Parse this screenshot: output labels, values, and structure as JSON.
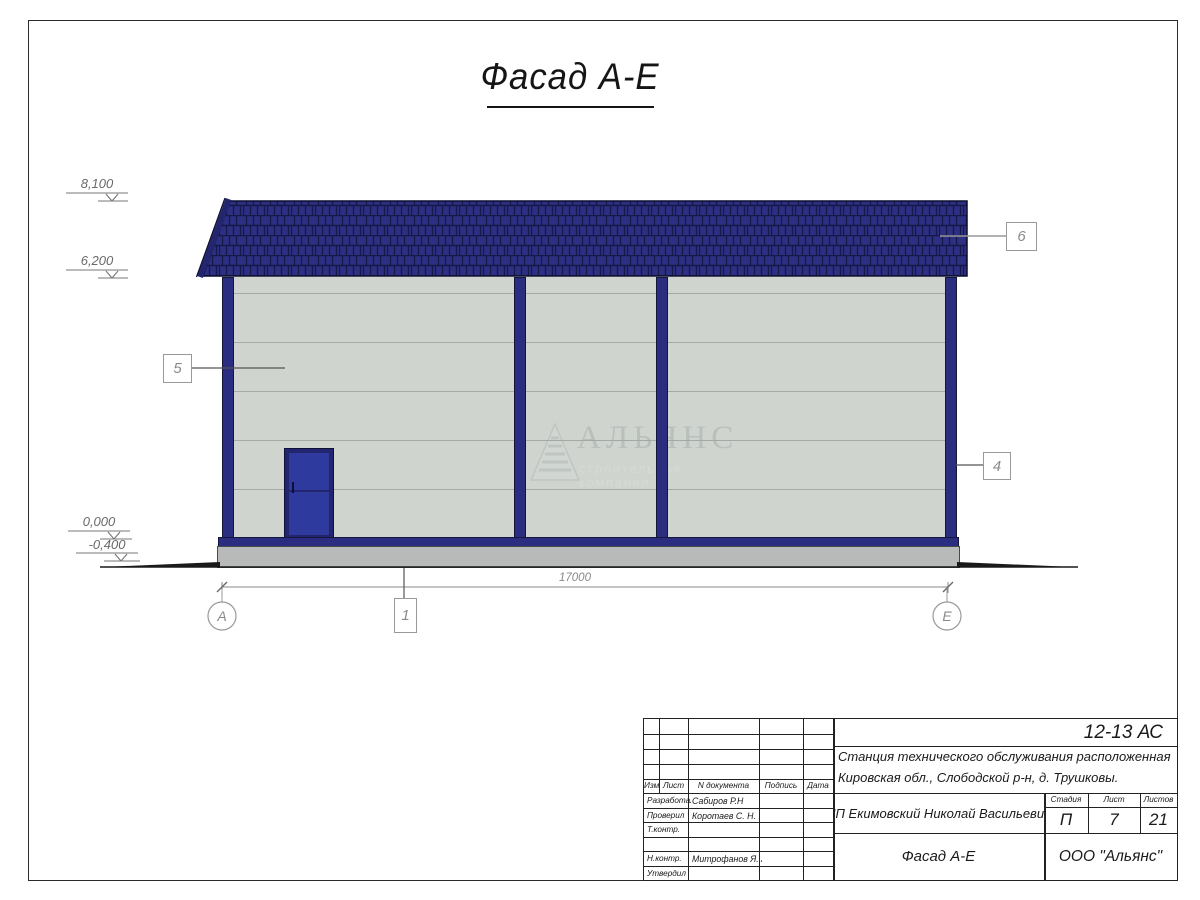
{
  "page": {
    "title": "Фасад А-Е"
  },
  "drawing": {
    "elevation_marks": [
      {
        "value": "8,100"
      },
      {
        "value": "6,200"
      },
      {
        "value": "0,000"
      },
      {
        "value": "-0,400"
      }
    ],
    "callouts": [
      {
        "label": "5"
      },
      {
        "label": "6"
      },
      {
        "label": "4"
      },
      {
        "label": "1"
      }
    ],
    "dimension_total": "17000",
    "axis_left": "А",
    "axis_right": "Е",
    "watermark_title": "АЛЬЯНС",
    "watermark_subtitle": "строительная компания"
  },
  "colors": {
    "roof": "#2c2f82",
    "roof_joint": "#161848",
    "wall": "#cfd4cf",
    "panel_line": "#a3a9a4",
    "trim": "#2b2e80",
    "door": "#2f3a9e",
    "plinth": "#b7bab8"
  },
  "titleblock": {
    "doc_code": "12-13 АС",
    "project_line1": "Станция технического обслуживания расположенная по адресу",
    "project_line2": "Кировская обл., Слободской р-н, д. Трушковы.",
    "client": "ИП Екимовский Николай Васильевич",
    "sheet_name": "Фасад А-Е",
    "company": "ООО \"Альянс\"",
    "stage_label": "Стадия",
    "stage_value": "П",
    "sheet_label": "Лист",
    "sheet_value": "7",
    "sheets_label": "Листов",
    "sheets_value": "21",
    "columns": [
      "Изм.",
      "Лист",
      "N документа",
      "Подпись",
      "Дата"
    ],
    "signature_rows": [
      {
        "role": "Разработал",
        "name": "Сабиров Р.Н"
      },
      {
        "role": "Проверил",
        "name": "Коротаев С. Н."
      },
      {
        "role": "Т.контр.",
        "name": ""
      },
      {
        "role": "",
        "name": ""
      },
      {
        "role": "Н.контр.",
        "name": "Митрофанов Я. А."
      },
      {
        "role": "Утвердил",
        "name": ""
      }
    ]
  }
}
